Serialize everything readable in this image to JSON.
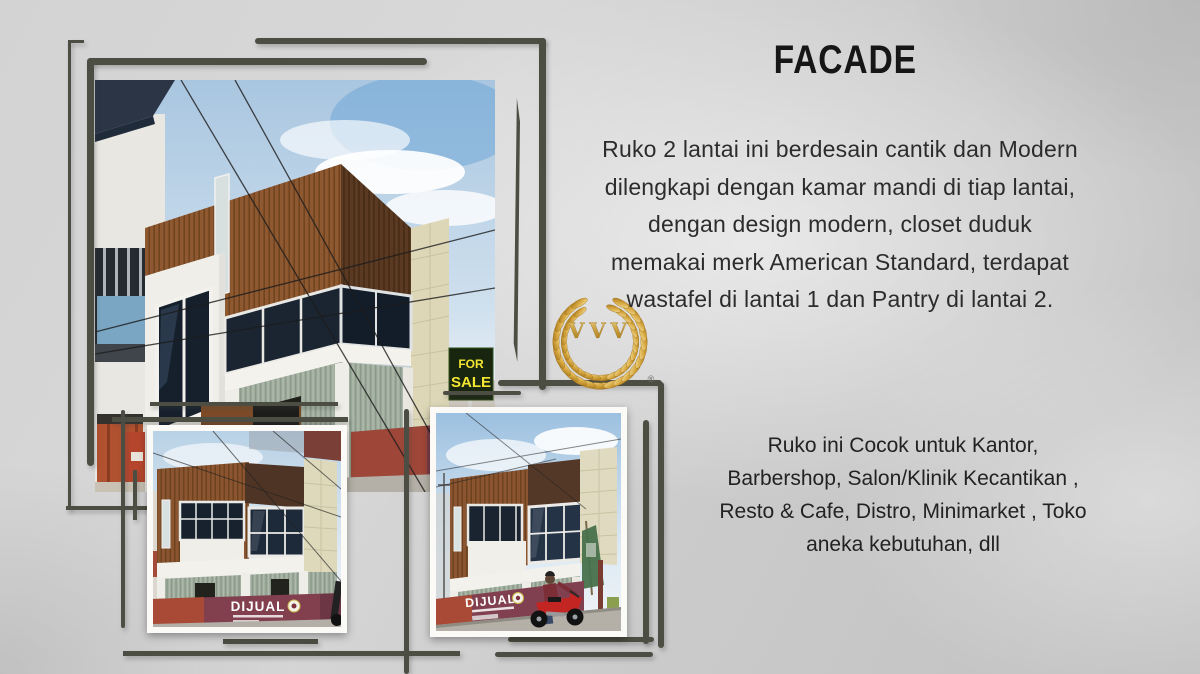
{
  "slide": {
    "title": "FACADE",
    "intro_lines": [
      "Ruko 2 lantai ini berdesain cantik dan Modern",
      "dilengkapi dengan kamar mandi di tiap lantai,",
      "dengan design modern, closet duduk",
      "memakai merk American Standard, terdapat",
      "wastafel di lantai 1 dan Pantry di lantai 2."
    ],
    "usage_lines": [
      "Ruko ini Cocok untuk Kantor,",
      "Barbershop, Salon/Klinik  Kecantikan ,",
      "Resto & Cafe, Distro, Minimarket , Toko",
      "aneka kebutuhan, dll"
    ]
  },
  "logo": {
    "monogram": "VVV",
    "registered_mark": "®"
  },
  "photo_overlays": {
    "banner_text": "DIJUAL",
    "for_sale_sign": {
      "line1": "FOR",
      "line2": "SALE"
    }
  },
  "colors": {
    "background": "#cbcbcb",
    "sketch_frame": "#4d4e43",
    "title_text": "#161616",
    "body_text": "#2c2c2c",
    "gold": "#c79a36",
    "banner_maroon": "#7d4050",
    "banner_red": "#a84a36",
    "wood_brown": "#8a5530",
    "panel_cream": "#ded9bb",
    "metal_sage": "#a0ad9d"
  }
}
